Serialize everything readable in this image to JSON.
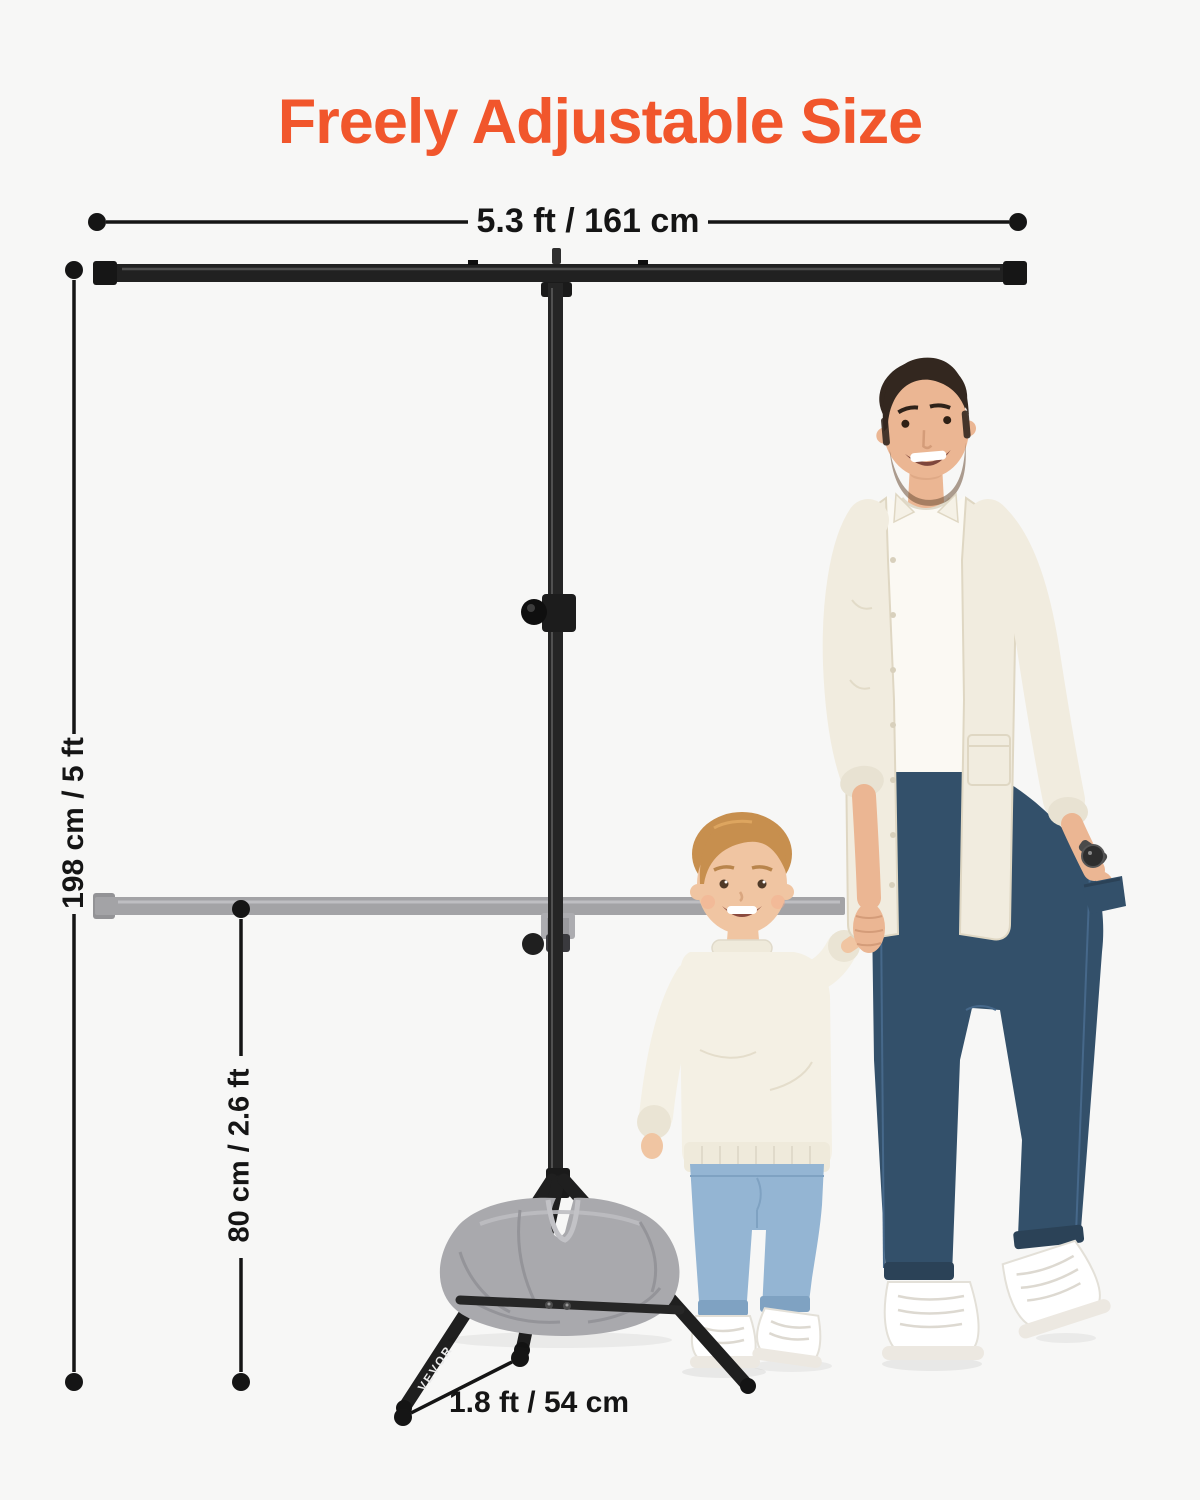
{
  "title": {
    "text": "Freely Adjustable Size"
  },
  "dimensions": {
    "crossbar_width": "5.3 ft / 161 cm",
    "max_height": "198 cm / 5 ft",
    "min_height": "80 cm / 2.6 ft",
    "base_leg_length": "1.8 ft / 54 cm"
  },
  "brand_label": "VEVOR",
  "scene": {
    "stand_parts": [
      "top-crossbar",
      "telescoping-pole",
      "height-adjustment-knob",
      "lowered-crossbar-ghost",
      "tripod-legs",
      "weight-sandbag"
    ],
    "figures": [
      "man-holding-childs-hand",
      "child-boy-walking"
    ]
  },
  "colors": {
    "background": "#f7f7f6",
    "accent_orange": "#f1562c",
    "dimension_line": "#151515",
    "stand_black": "#212121",
    "ghost_gray": "#a3a3a6",
    "sandbag_gray": "#a9a9ad",
    "man_jeans": "#33506a",
    "boy_jeans": "#94b5d3",
    "shirt_cream": "#f1ecdf"
  }
}
